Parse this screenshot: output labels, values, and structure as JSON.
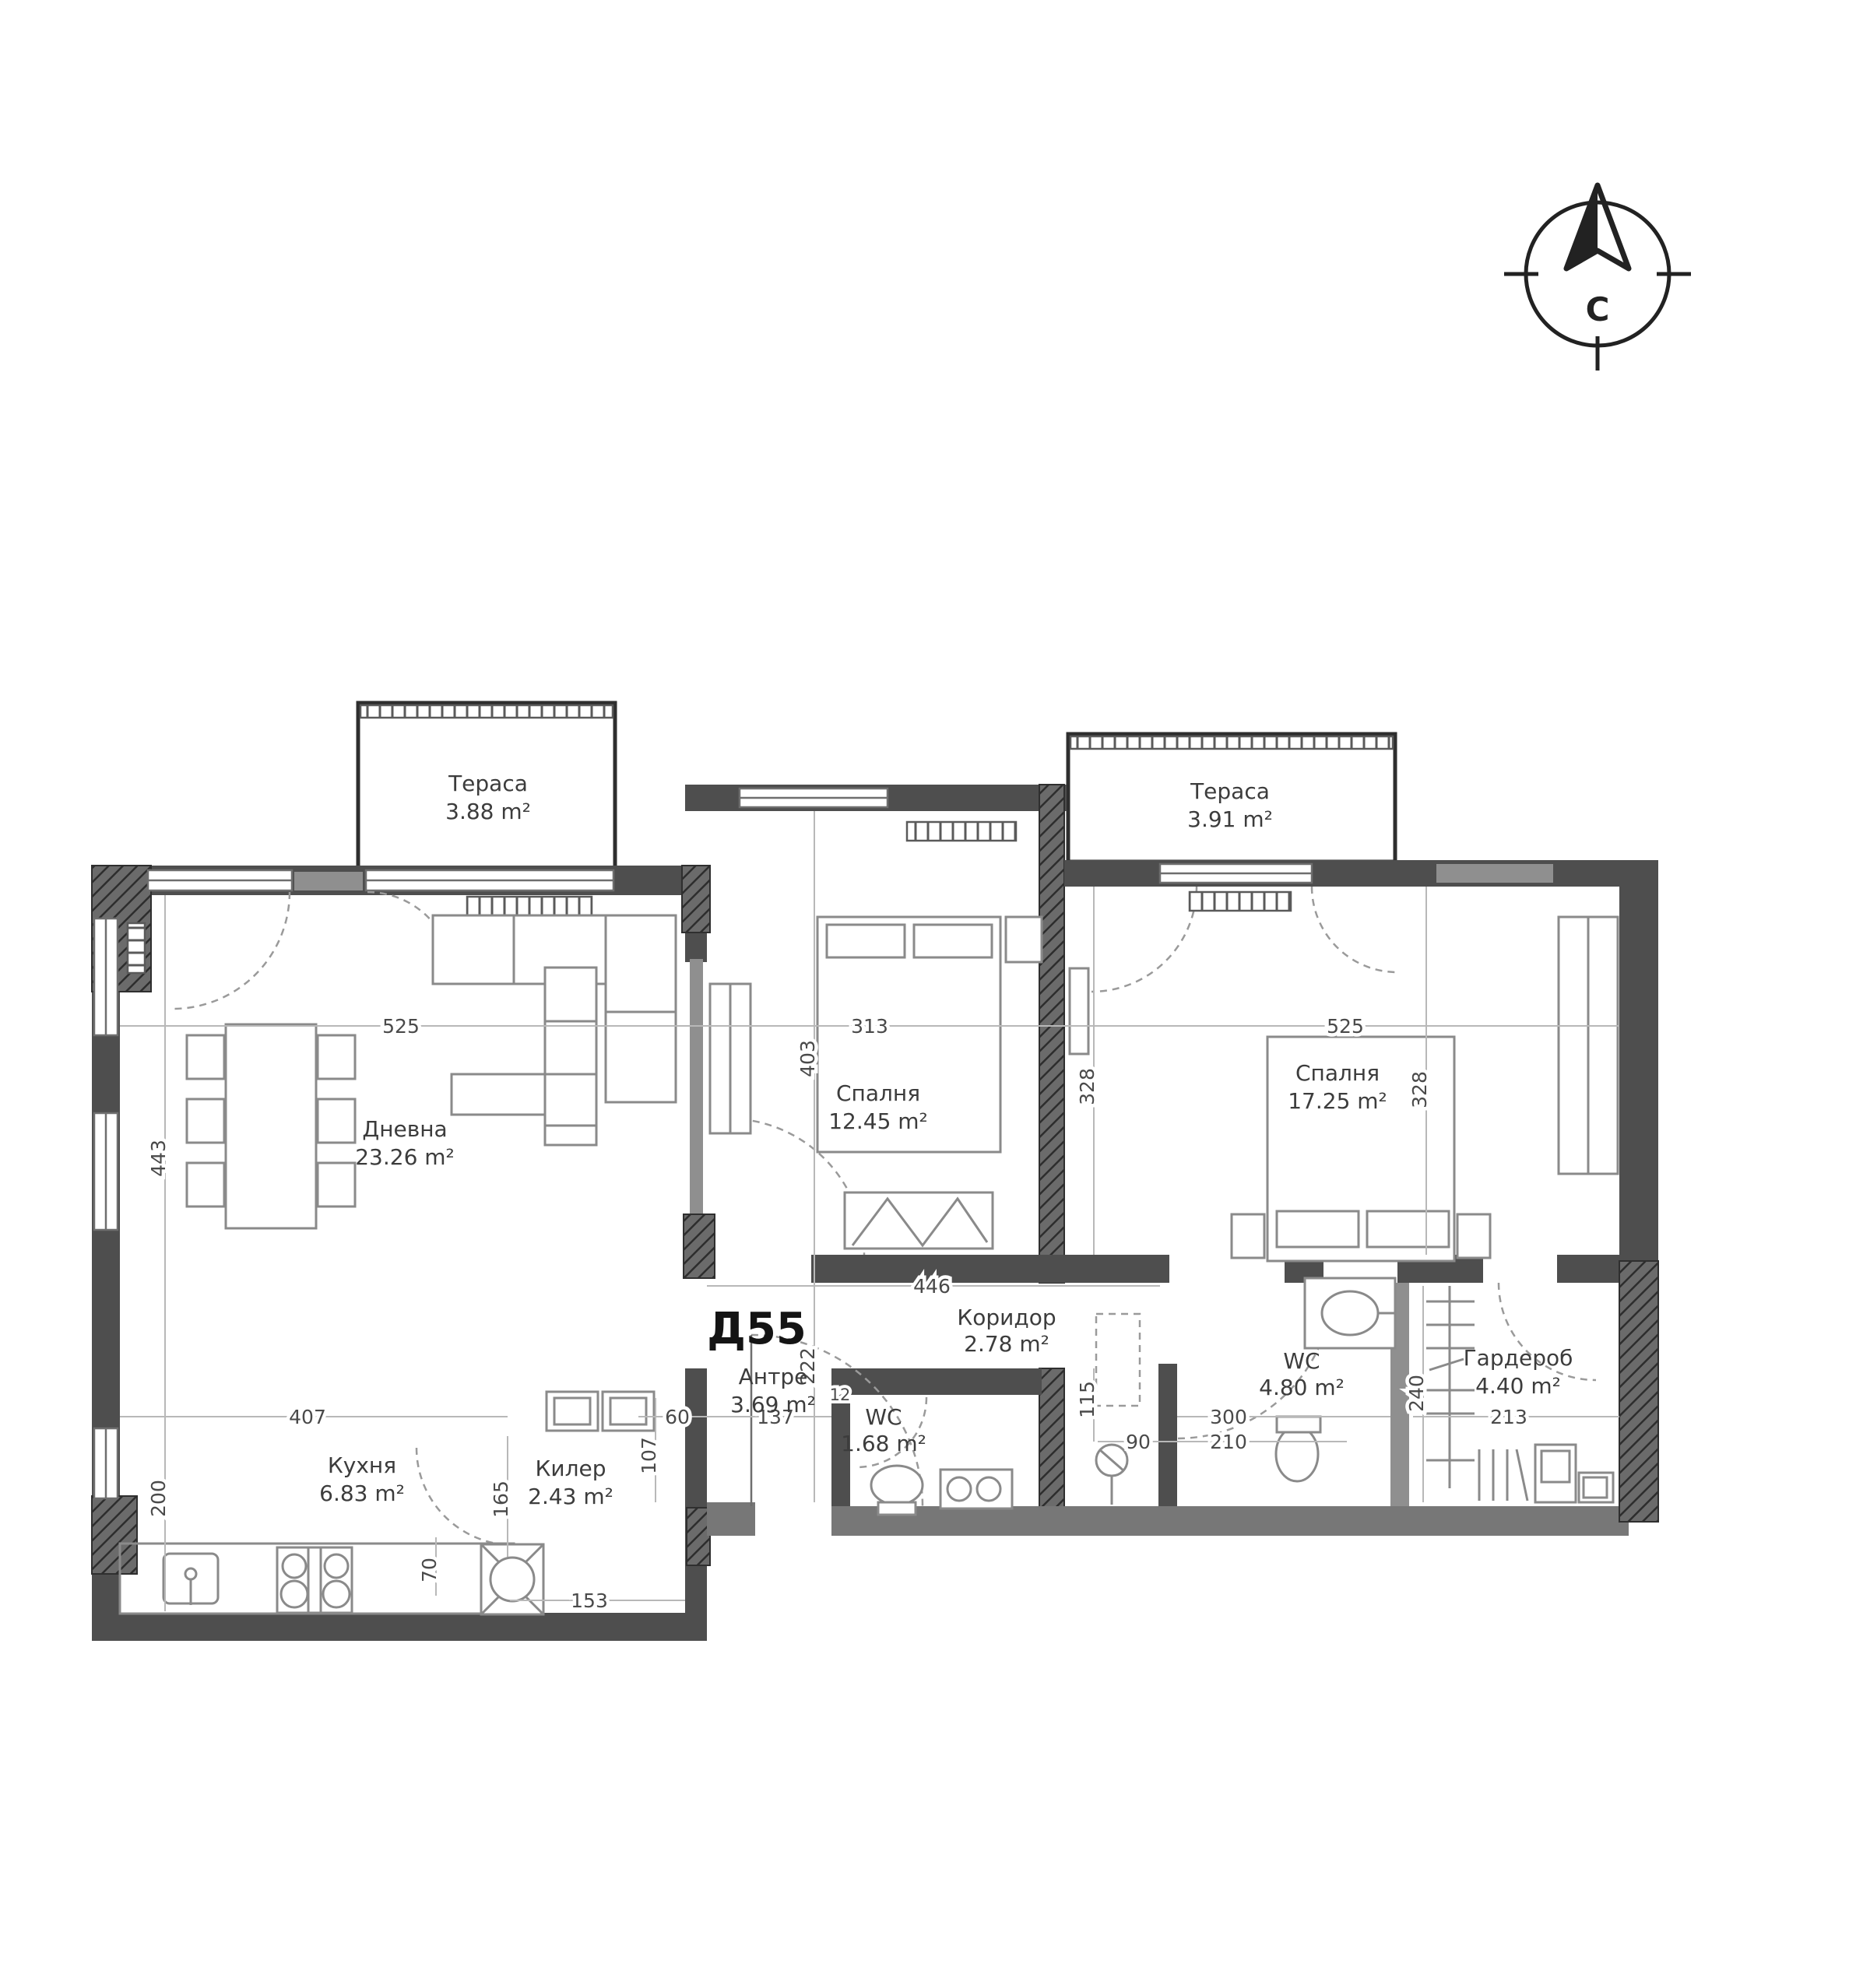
{
  "plan": {
    "unit_id": "Д55",
    "compass": {
      "label": "С"
    },
    "rooms": [
      {
        "key": "terrace-left",
        "name": "Тераса",
        "area": "3.88 m²"
      },
      {
        "key": "living",
        "name": "Дневна",
        "area": "23.26 m²"
      },
      {
        "key": "bedroom-1",
        "name": "Спалня",
        "area": "12.45 m²"
      },
      {
        "key": "terrace-right",
        "name": "Тераса",
        "area": "3.91 m²"
      },
      {
        "key": "bedroom-2",
        "name": "Спалня",
        "area": "17.25 m²"
      },
      {
        "key": "kitchen",
        "name": "Кухня",
        "area": "6.83 m²"
      },
      {
        "key": "storage",
        "name": "Килер",
        "area": "2.43 m²"
      },
      {
        "key": "entry",
        "name": "Антре",
        "area": "3.69 m²"
      },
      {
        "key": "wc-1",
        "name": "WC",
        "area": "1.68 m²"
      },
      {
        "key": "corridor",
        "name": "Коридор",
        "area": "2.78 m²"
      },
      {
        "key": "wc-2",
        "name": "WC",
        "area": "4.80 m²"
      },
      {
        "key": "closet",
        "name": "Гардероб",
        "area": "4.40 m²"
      }
    ],
    "dims": {
      "living_w": "525",
      "bed1_w": "313",
      "bed2_w": "525",
      "living_h": "443",
      "bed1_h": "403",
      "bed2_hl": "328",
      "bed2_hr": "328",
      "corr_w": "446",
      "entry_h": "222",
      "kitchen_w": "407",
      "kitchen_h": "200",
      "entry_w": "137",
      "d60": "60",
      "d12": "12",
      "d107": "107",
      "d165": "165",
      "d70": "70",
      "storage_w": "153",
      "wc2_w": "300",
      "wc2_w2": "210",
      "d90": "90",
      "wc2_h": "115",
      "closet_w": "213",
      "closet_h": "240"
    }
  }
}
